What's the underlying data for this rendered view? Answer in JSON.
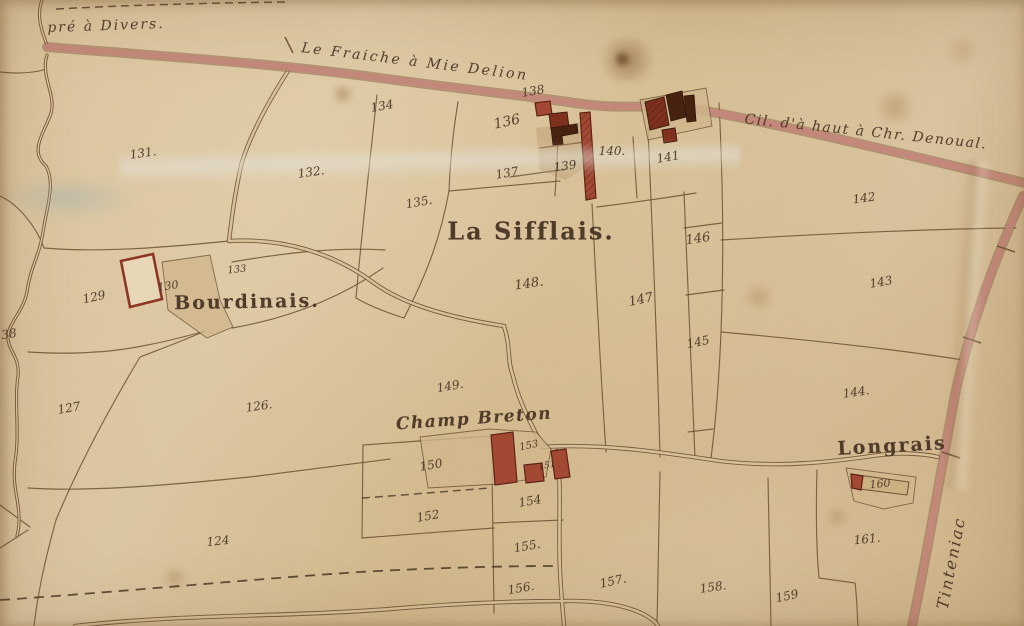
{
  "map": {
    "kind": "hand-drawn cadastral parish map",
    "colors": {
      "parchment": "#d8c199",
      "parchment_light": "#e0cdab",
      "ink": "#4a3625",
      "boundary": "#6b5133",
      "road_pink": "#c4887a",
      "road_edge": "#86644299",
      "stream_brown": "#7a5a36",
      "yard_tan": "#d2b88d",
      "building_red": "#a34732",
      "building_dark_red": "#7e2f1c",
      "building_maroon": "#46200f"
    },
    "place_labels": [
      {
        "name": "label-pre-a-divers",
        "text": "pré à Divers.",
        "x": 106,
        "y": 26,
        "rot": -2,
        "size": 14,
        "kind": "road"
      },
      {
        "name": "label-le-fraiche-a-mie-delion",
        "text": "Le Fraiche à Mie Delion",
        "x": 415,
        "y": 62,
        "rot": 7,
        "size": 14,
        "kind": "road",
        "spacing": 2.5
      },
      {
        "name": "label-cil-da-haut-a-chr-denoual",
        "text": "Cil. d'à haut à Chr. Denoual.",
        "x": 866,
        "y": 132,
        "rot": 6,
        "size": 14,
        "kind": "road",
        "spacing": 1.5
      },
      {
        "name": "label-la-sifflais",
        "text": "La Sifflais.",
        "x": 531,
        "y": 231,
        "rot": 0,
        "size": 24,
        "kind": "place"
      },
      {
        "name": "label-bourdinais",
        "text": "Bourdinais.",
        "x": 247,
        "y": 302,
        "rot": -1,
        "size": 19,
        "kind": "place"
      },
      {
        "name": "label-champ-breton",
        "text": "Champ Breton",
        "x": 474,
        "y": 419,
        "rot": -4,
        "size": 17,
        "kind": "hamlet"
      },
      {
        "name": "label-longrais",
        "text": "Longrais",
        "x": 892,
        "y": 446,
        "rot": -3,
        "size": 19,
        "kind": "place"
      },
      {
        "name": "label-tinteniac",
        "text": "Tinteniac",
        "x": 951,
        "y": 563,
        "rot": -79,
        "size": 16,
        "kind": "road",
        "spacing": 2
      }
    ],
    "parcel_numbers": [
      {
        "text": "131.",
        "x": 143,
        "y": 153,
        "rot": -8
      },
      {
        "text": "132.",
        "x": 311,
        "y": 172,
        "rot": -8
      },
      {
        "text": "133",
        "x": 237,
        "y": 270,
        "rot": -6,
        "size": 10
      },
      {
        "text": "134",
        "x": 382,
        "y": 106,
        "rot": -10
      },
      {
        "text": "135.",
        "x": 419,
        "y": 202,
        "rot": -10
      },
      {
        "text": "136",
        "x": 507,
        "y": 122,
        "rot": -12,
        "size": 14
      },
      {
        "text": "137",
        "x": 507,
        "y": 173,
        "rot": -10
      },
      {
        "text": "138",
        "x": 533,
        "y": 91,
        "rot": -10
      },
      {
        "text": "139",
        "x": 565,
        "y": 166,
        "rot": -8
      },
      {
        "text": "140.",
        "x": 612,
        "y": 151,
        "rot": 0
      },
      {
        "text": "141",
        "x": 668,
        "y": 157,
        "rot": -10
      },
      {
        "text": "142",
        "x": 864,
        "y": 198,
        "rot": -8
      },
      {
        "text": "143",
        "x": 881,
        "y": 282,
        "rot": -10
      },
      {
        "text": "144.",
        "x": 856,
        "y": 392,
        "rot": -8
      },
      {
        "text": "145",
        "x": 698,
        "y": 342,
        "rot": -12
      },
      {
        "text": "146",
        "x": 698,
        "y": 239,
        "rot": -8,
        "size": 13
      },
      {
        "text": "147",
        "x": 641,
        "y": 300,
        "rot": -12,
        "size": 13
      },
      {
        "text": "148.",
        "x": 529,
        "y": 284,
        "rot": -8,
        "size": 13
      },
      {
        "text": "149.",
        "x": 450,
        "y": 386,
        "rot": -10
      },
      {
        "text": "150",
        "x": 431,
        "y": 465,
        "rot": -10
      },
      {
        "text": "151",
        "x": 547,
        "y": 466,
        "rot": -10,
        "size": 9
      },
      {
        "text": "152",
        "x": 428,
        "y": 516,
        "rot": -10
      },
      {
        "text": "153",
        "x": 529,
        "y": 446,
        "rot": -12,
        "size": 10
      },
      {
        "text": "154",
        "x": 530,
        "y": 501,
        "rot": -10
      },
      {
        "text": "155.",
        "x": 527,
        "y": 546,
        "rot": -10
      },
      {
        "text": "156.",
        "x": 521,
        "y": 588,
        "rot": -10
      },
      {
        "text": "157.",
        "x": 613,
        "y": 581,
        "rot": -12
      },
      {
        "text": "158.",
        "x": 713,
        "y": 587,
        "rot": -8
      },
      {
        "text": "159",
        "x": 787,
        "y": 596,
        "rot": -12
      },
      {
        "text": "160",
        "x": 880,
        "y": 484,
        "rot": -5,
        "size": 11
      },
      {
        "text": "161.",
        "x": 867,
        "y": 539,
        "rot": -6
      },
      {
        "text": "124",
        "x": 218,
        "y": 541,
        "rot": -6
      },
      {
        "text": "126.",
        "x": 259,
        "y": 406,
        "rot": -8
      },
      {
        "text": "127",
        "x": 69,
        "y": 408,
        "rot": -10
      },
      {
        "text": "129",
        "x": 94,
        "y": 297,
        "rot": -12
      },
      {
        "text": "130",
        "x": 168,
        "y": 286,
        "rot": -8,
        "size": 11
      },
      {
        "text": "38",
        "x": 9,
        "y": 334,
        "rot": -10
      }
    ]
  }
}
